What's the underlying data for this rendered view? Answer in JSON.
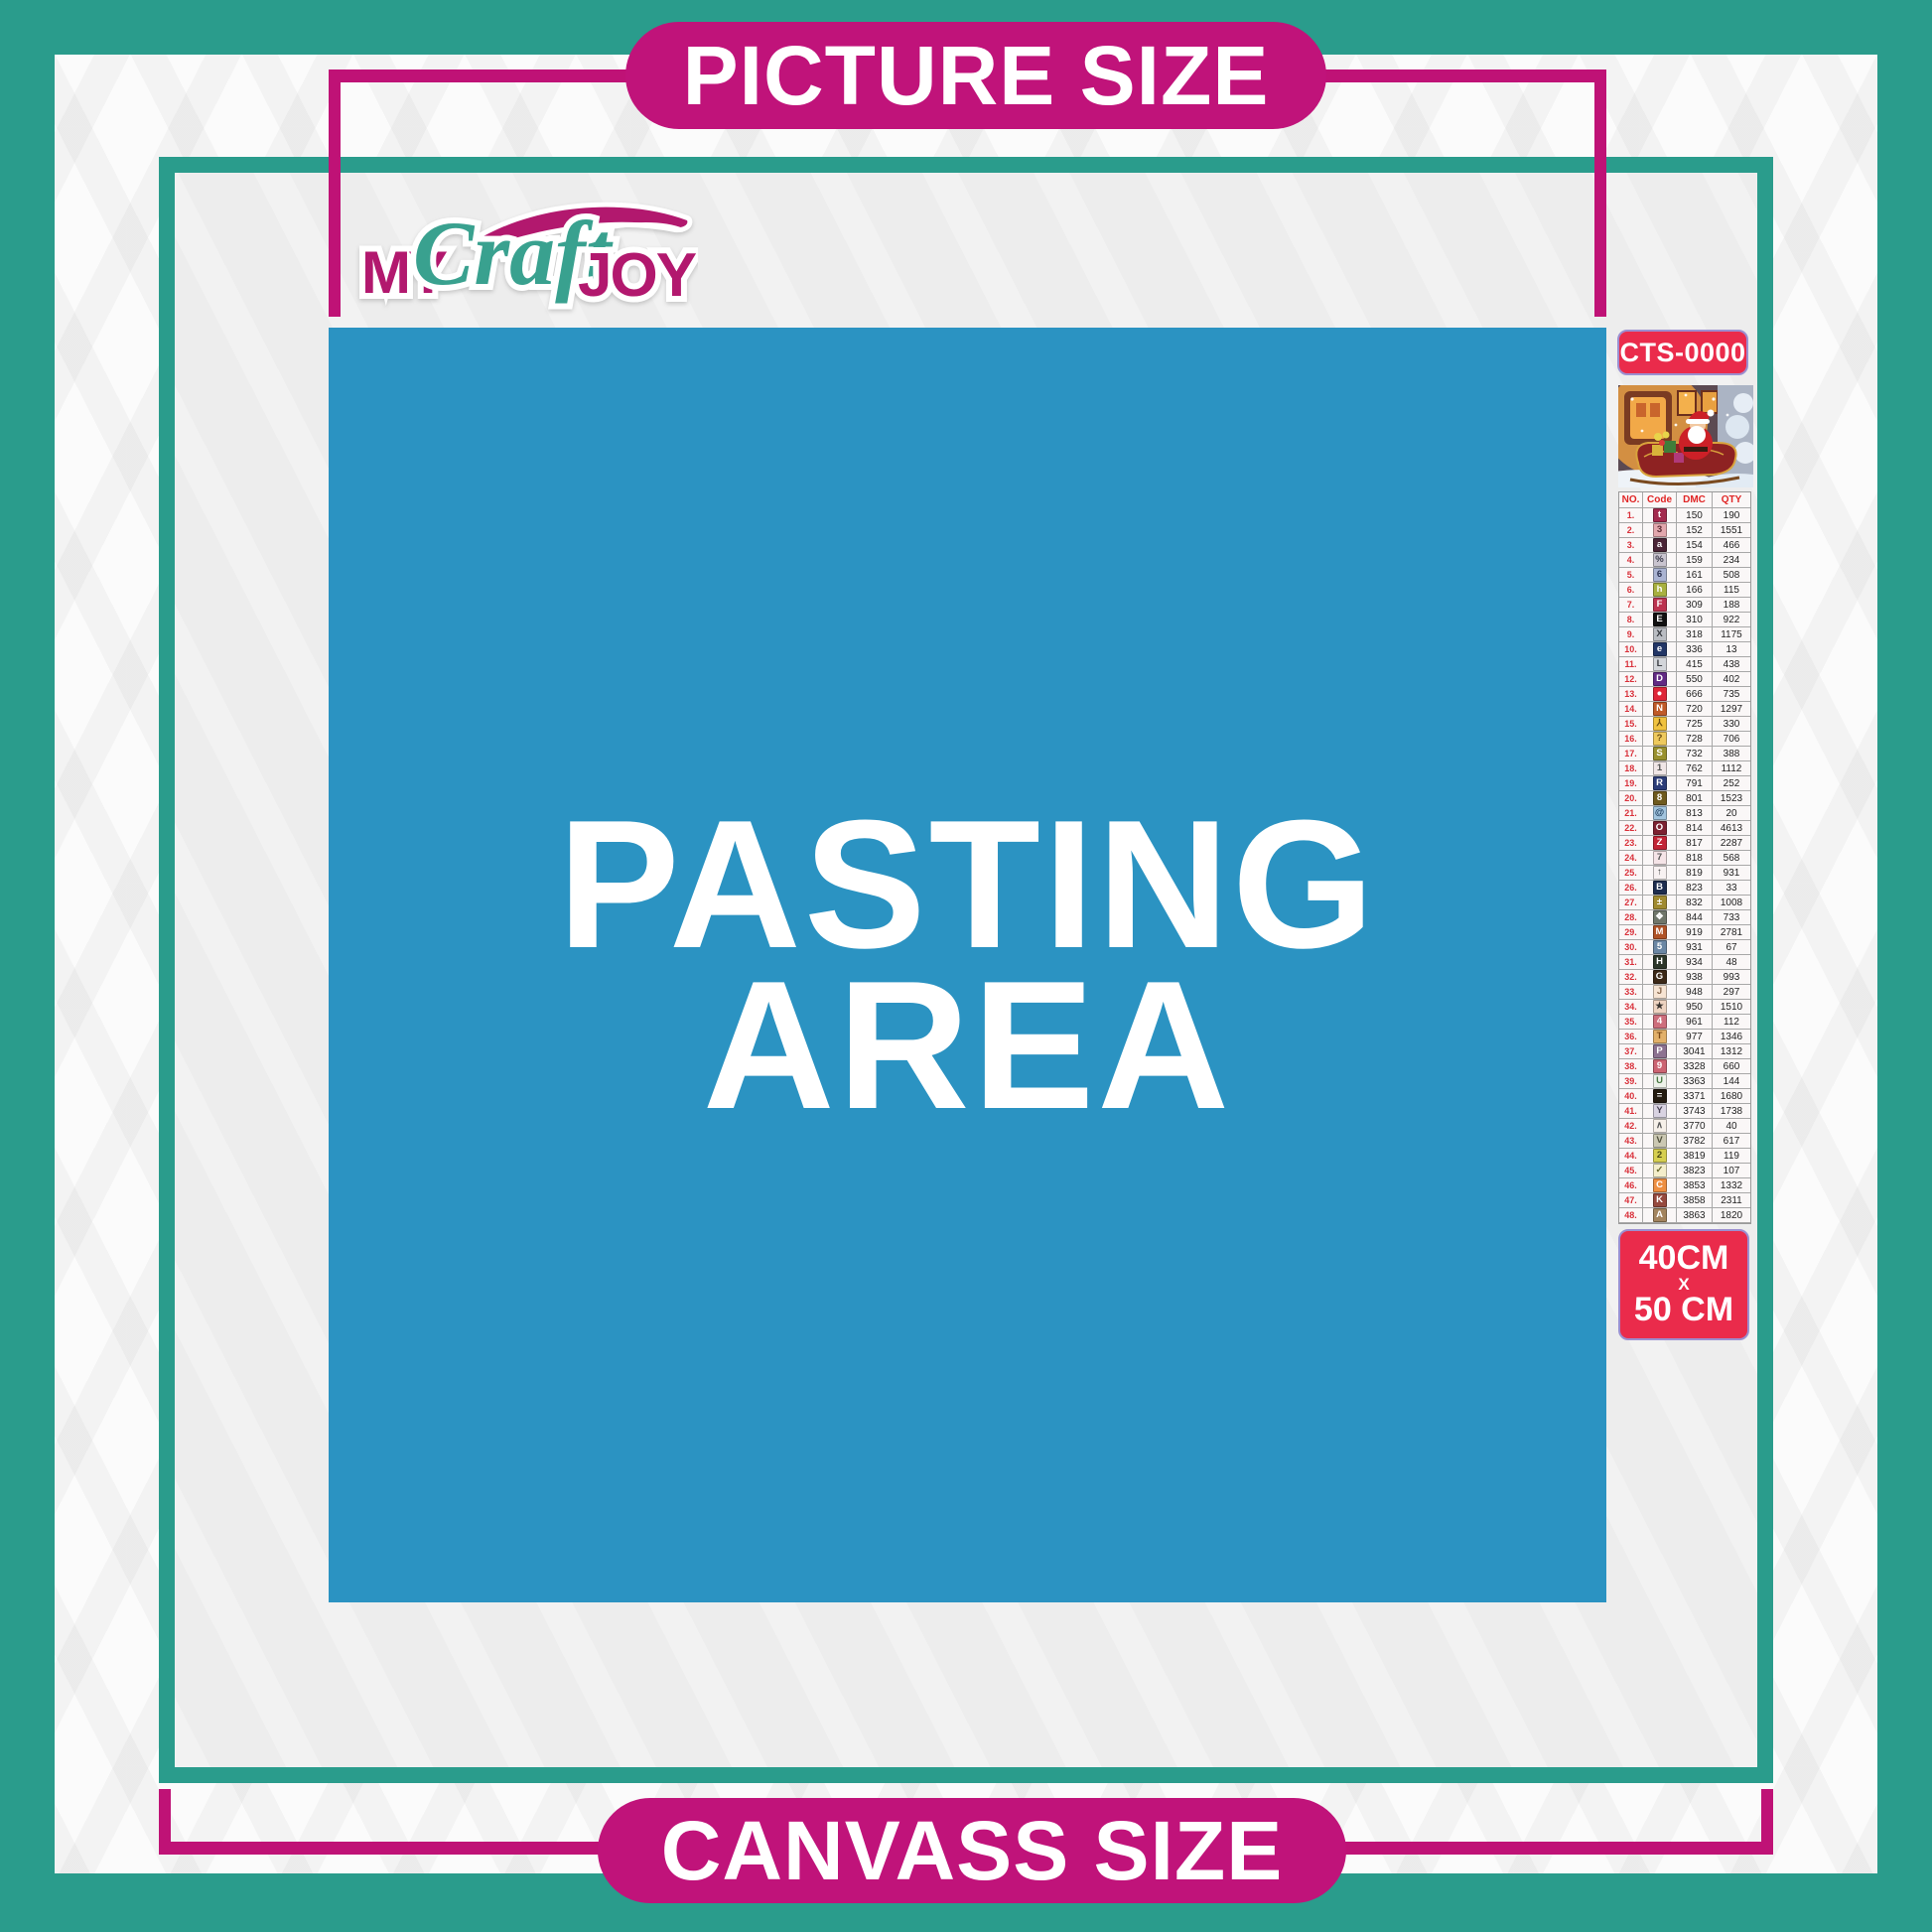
{
  "title_banners": {
    "picture_size": "PICTURE SIZE",
    "canvass_size": "CANVASS SIZE"
  },
  "brand": {
    "word1": "MY",
    "word2": "Craft",
    "word3": "JOY"
  },
  "pasting_area": {
    "line1": "PASTING",
    "line2": "AREA"
  },
  "product": {
    "code": "CTS-0000",
    "canvas_size": {
      "width": "40CM",
      "separator": "X",
      "height": "50 CM"
    }
  },
  "legend": {
    "headers": [
      "NO.",
      "Code",
      "DMC",
      "QTY"
    ],
    "rows": [
      {
        "no": "1.",
        "sym": "t",
        "dmc": "150",
        "qty": "190",
        "bg": "#a32a4e",
        "fg": "#ffffff"
      },
      {
        "no": "2.",
        "sym": "3",
        "dmc": "152",
        "qty": "1551",
        "bg": "#e2a7ad",
        "fg": "#5a2a33"
      },
      {
        "no": "3.",
        "sym": "a",
        "dmc": "154",
        "qty": "466",
        "bg": "#4a2436",
        "fg": "#ffffff"
      },
      {
        "no": "4.",
        "sym": "%",
        "dmc": "159",
        "qty": "234",
        "bg": "#c9c4cf",
        "fg": "#3a3a4a"
      },
      {
        "no": "5.",
        "sym": "6",
        "dmc": "161",
        "qty": "508",
        "bg": "#aab3d2",
        "fg": "#2a3050"
      },
      {
        "no": "6.",
        "sym": "h",
        "dmc": "166",
        "qty": "115",
        "bg": "#a8b040",
        "fg": "#ffffff"
      },
      {
        "no": "7.",
        "sym": "F",
        "dmc": "309",
        "qty": "188",
        "bg": "#bc3350",
        "fg": "#ffffff"
      },
      {
        "no": "8.",
        "sym": "E",
        "dmc": "310",
        "qty": "922",
        "bg": "#111111",
        "fg": "#ffffff"
      },
      {
        "no": "9.",
        "sym": "X",
        "dmc": "318",
        "qty": "1175",
        "bg": "#b9bcc2",
        "fg": "#33363c"
      },
      {
        "no": "10.",
        "sym": "e",
        "dmc": "336",
        "qty": "13",
        "bg": "#233666",
        "fg": "#ffffff"
      },
      {
        "no": "11.",
        "sym": "L",
        "dmc": "415",
        "qty": "438",
        "bg": "#d3d5da",
        "fg": "#3c3e44"
      },
      {
        "no": "12.",
        "sym": "D",
        "dmc": "550",
        "qty": "402",
        "bg": "#622a84",
        "fg": "#ffffff"
      },
      {
        "no": "13.",
        "sym": "●",
        "dmc": "666",
        "qty": "735",
        "bg": "#df2638",
        "fg": "#ffffff"
      },
      {
        "no": "14.",
        "sym": "N",
        "dmc": "720",
        "qty": "1297",
        "bg": "#c05a28",
        "fg": "#ffffff"
      },
      {
        "no": "15.",
        "sym": "⅄",
        "dmc": "725",
        "qty": "330",
        "bg": "#f0c23e",
        "fg": "#6a4c10"
      },
      {
        "no": "16.",
        "sym": "?",
        "dmc": "728",
        "qty": "706",
        "bg": "#eec95d",
        "fg": "#6a4c10"
      },
      {
        "no": "17.",
        "sym": "S",
        "dmc": "732",
        "qty": "388",
        "bg": "#99902e",
        "fg": "#ffffff"
      },
      {
        "no": "18.",
        "sym": "1",
        "dmc": "762",
        "qty": "1112",
        "bg": "#f0e6e6",
        "fg": "#555555"
      },
      {
        "no": "19.",
        "sym": "R",
        "dmc": "791",
        "qty": "252",
        "bg": "#2c3c78",
        "fg": "#ffffff"
      },
      {
        "no": "20.",
        "sym": "8",
        "dmc": "801",
        "qty": "1523",
        "bg": "#6f5a1e",
        "fg": "#ffffff"
      },
      {
        "no": "21.",
        "sym": "@",
        "dmc": "813",
        "qty": "20",
        "bg": "#a2c4de",
        "fg": "#1c3c5c"
      },
      {
        "no": "22.",
        "sym": "O",
        "dmc": "814",
        "qty": "4613",
        "bg": "#7c2231",
        "fg": "#ffffff"
      },
      {
        "no": "23.",
        "sym": "Z",
        "dmc": "817",
        "qty": "2287",
        "bg": "#c22536",
        "fg": "#ffffff"
      },
      {
        "no": "24.",
        "sym": "7",
        "dmc": "818",
        "qty": "568",
        "bg": "#f5e4e7",
        "fg": "#555555"
      },
      {
        "no": "25.",
        "sym": "↑",
        "dmc": "819",
        "qty": "931",
        "bg": "#f8f2f2",
        "fg": "#444444"
      },
      {
        "no": "26.",
        "sym": "B",
        "dmc": "823",
        "qty": "33",
        "bg": "#1d2c4e",
        "fg": "#ffffff"
      },
      {
        "no": "27.",
        "sym": "±",
        "dmc": "832",
        "qty": "1008",
        "bg": "#a08a30",
        "fg": "#ffffff"
      },
      {
        "no": "28.",
        "sym": "❖",
        "dmc": "844",
        "qty": "733",
        "bg": "#70766a",
        "fg": "#ffffff"
      },
      {
        "no": "29.",
        "sym": "M",
        "dmc": "919",
        "qty": "2781",
        "bg": "#b05226",
        "fg": "#ffffff"
      },
      {
        "no": "30.",
        "sym": "5",
        "dmc": "931",
        "qty": "67",
        "bg": "#6c87a4",
        "fg": "#ffffff"
      },
      {
        "no": "31.",
        "sym": "H",
        "dmc": "934",
        "qty": "48",
        "bg": "#2c3629",
        "fg": "#ffffff"
      },
      {
        "no": "32.",
        "sym": "G",
        "dmc": "938",
        "qty": "993",
        "bg": "#3c2817",
        "fg": "#ffffff"
      },
      {
        "no": "33.",
        "sym": "J",
        "dmc": "948",
        "qty": "297",
        "bg": "#f7e4d3",
        "fg": "#8a6a50"
      },
      {
        "no": "34.",
        "sym": "★",
        "dmc": "950",
        "qty": "1510",
        "bg": "#eed3c1",
        "fg": "#3a3430"
      },
      {
        "no": "35.",
        "sym": "4",
        "dmc": "961",
        "qty": "112",
        "bg": "#ce6e7c",
        "fg": "#ffffff"
      },
      {
        "no": "36.",
        "sym": "T",
        "dmc": "977",
        "qty": "1346",
        "bg": "#e2b06a",
        "fg": "#7a4a1a"
      },
      {
        "no": "37.",
        "sym": "P",
        "dmc": "3041",
        "qty": "1312",
        "bg": "#8d7291",
        "fg": "#ffffff"
      },
      {
        "no": "38.",
        "sym": "9",
        "dmc": "3328",
        "qty": "660",
        "bg": "#cc6472",
        "fg": "#ffffff"
      },
      {
        "no": "39.",
        "sym": "U",
        "dmc": "3363",
        "qty": "144",
        "bg": "#eef2ea",
        "fg": "#4a7a44"
      },
      {
        "no": "40.",
        "sym": "=",
        "dmc": "3371",
        "qty": "1680",
        "bg": "#241b10",
        "fg": "#ffffff"
      },
      {
        "no": "41.",
        "sym": "Y",
        "dmc": "3743",
        "qty": "1738",
        "bg": "#d9d3e2",
        "fg": "#4a4456"
      },
      {
        "no": "42.",
        "sym": "∧",
        "dmc": "3770",
        "qty": "40",
        "bg": "#f6f0e9",
        "fg": "#555555"
      },
      {
        "no": "43.",
        "sym": "V",
        "dmc": "3782",
        "qty": "617",
        "bg": "#cbc8b2",
        "fg": "#50503c"
      },
      {
        "no": "44.",
        "sym": "2",
        "dmc": "3819",
        "qty": "119",
        "bg": "#d6cf50",
        "fg": "#4a4a14"
      },
      {
        "no": "45.",
        "sym": "✓",
        "dmc": "3823",
        "qty": "107",
        "bg": "#f4eecb",
        "fg": "#6a6a30"
      },
      {
        "no": "46.",
        "sym": "C",
        "dmc": "3853",
        "qty": "1332",
        "bg": "#ee8f42",
        "fg": "#ffffff"
      },
      {
        "no": "47.",
        "sym": "K",
        "dmc": "3858",
        "qty": "2311",
        "bg": "#96493e",
        "fg": "#ffffff"
      },
      {
        "no": "48.",
        "sym": "A",
        "dmc": "3863",
        "qty": "1820",
        "bg": "#a3845e",
        "fg": "#ffffff"
      }
    ]
  },
  "colors": {
    "teal": "#2a9c8c",
    "magenta": "#bf1276",
    "pill_magenta": "#c0137a",
    "pasting_blue": "#2b93c2",
    "badge_red": "#ea2b4b",
    "canvas_gray": "#ededed"
  }
}
